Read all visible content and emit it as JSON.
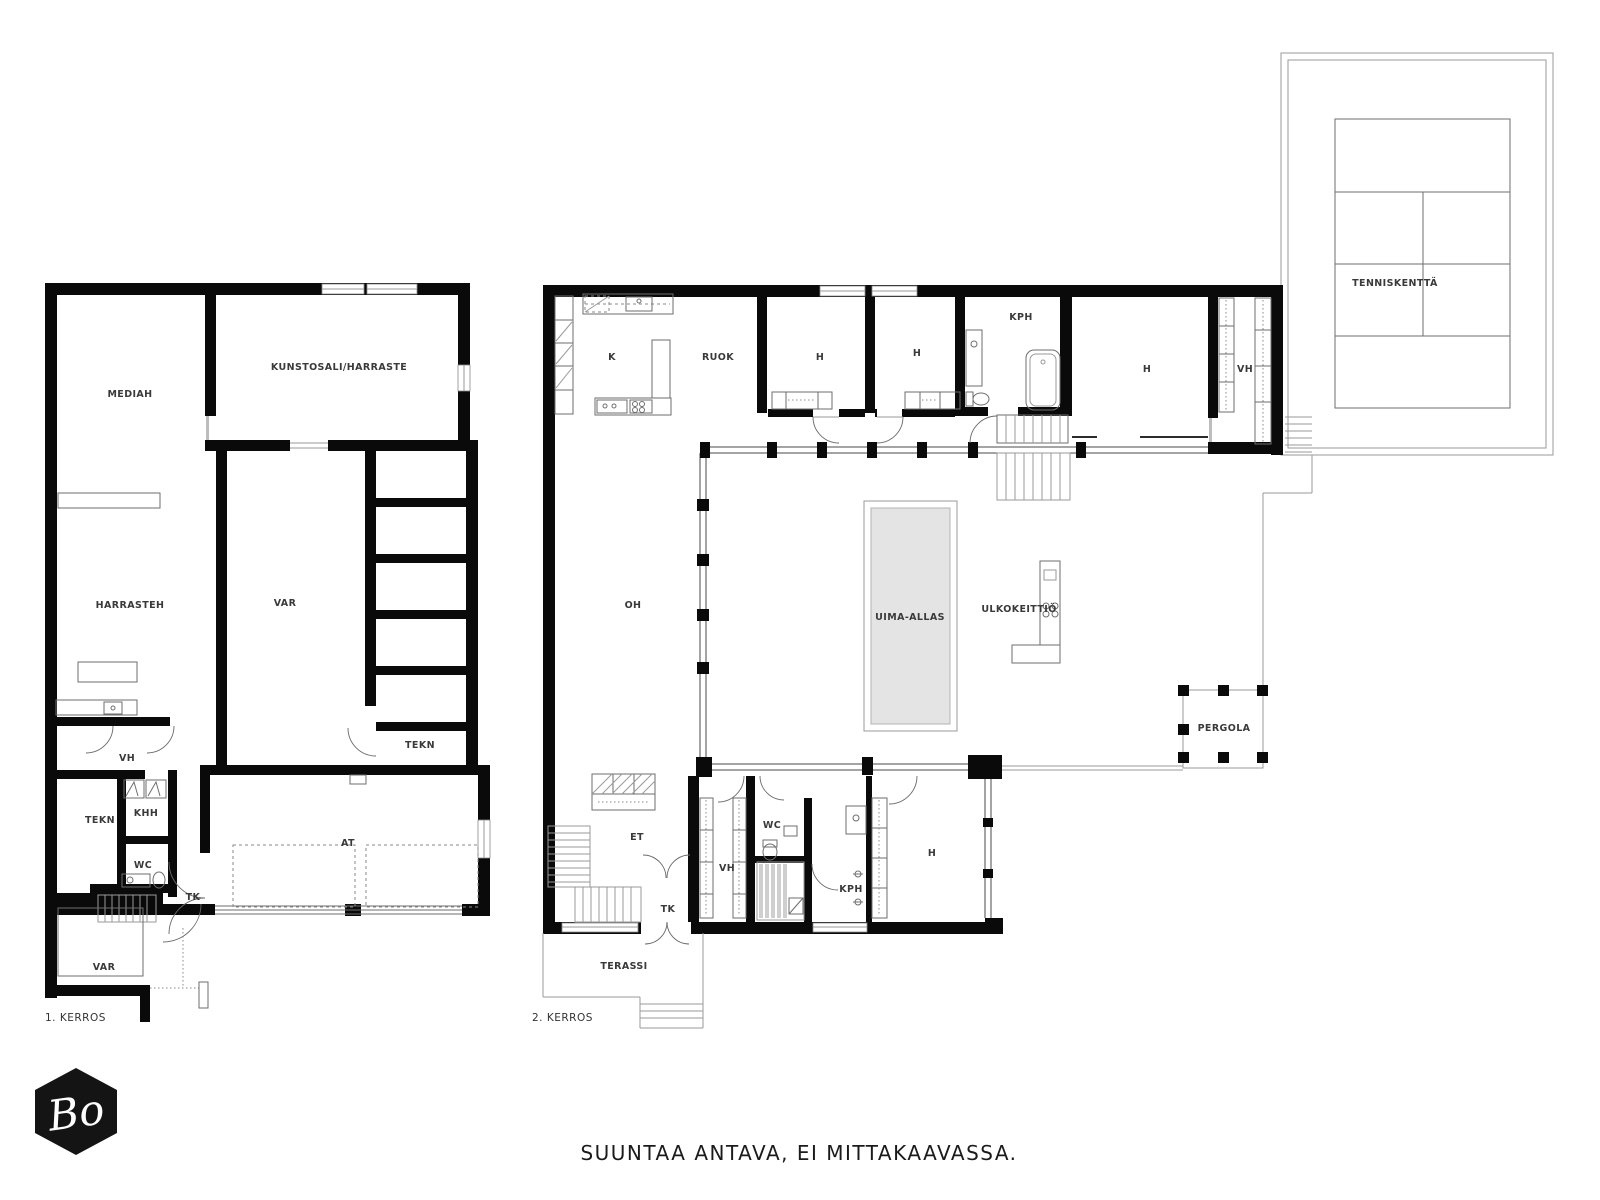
{
  "floor1": {
    "label": "1. KERROS",
    "rooms": {
      "mediah": "MEDIAH",
      "kunstosali": "KUNSTOSALI/HARRASTE",
      "harrasteh": "HARRASTEH",
      "var": "VAR",
      "tekn_store": "TEKN",
      "vh": "VH",
      "tekn": "TEKN",
      "khh": "KHH",
      "wc": "WC",
      "tk": "TK",
      "at": "AT",
      "var_out": "VAR"
    }
  },
  "floor2": {
    "label": "2. KERROS",
    "rooms": {
      "k": "K",
      "ruok": "RUOK",
      "h1": "H",
      "h2": "H",
      "kph_top": "KPH",
      "h3": "H",
      "vh_top": "VH",
      "oh": "OH",
      "uima_allas": "UIMA-ALLAS",
      "ulkokeittio": "ULKOKEITTIÖ",
      "pergola": "PERGOLA",
      "et": "ET",
      "wc": "WC",
      "vh_bottom": "VH",
      "kph_bottom": "KPH",
      "tk": "TK",
      "h4": "H",
      "terassi": "TERASSI"
    }
  },
  "site": {
    "tennis_court": "TENNISKENTTÄ"
  },
  "footer": {
    "disclaimer": "SUUNTAA ANTAVA, EI MITTAKAAVASSA."
  },
  "logo": {
    "monogram": "Bo"
  },
  "colors": {
    "wall": "#0a0a0a",
    "pool_fill": "#e4e4e4",
    "text": "#3a3a3a",
    "logo_bg": "#141414"
  }
}
